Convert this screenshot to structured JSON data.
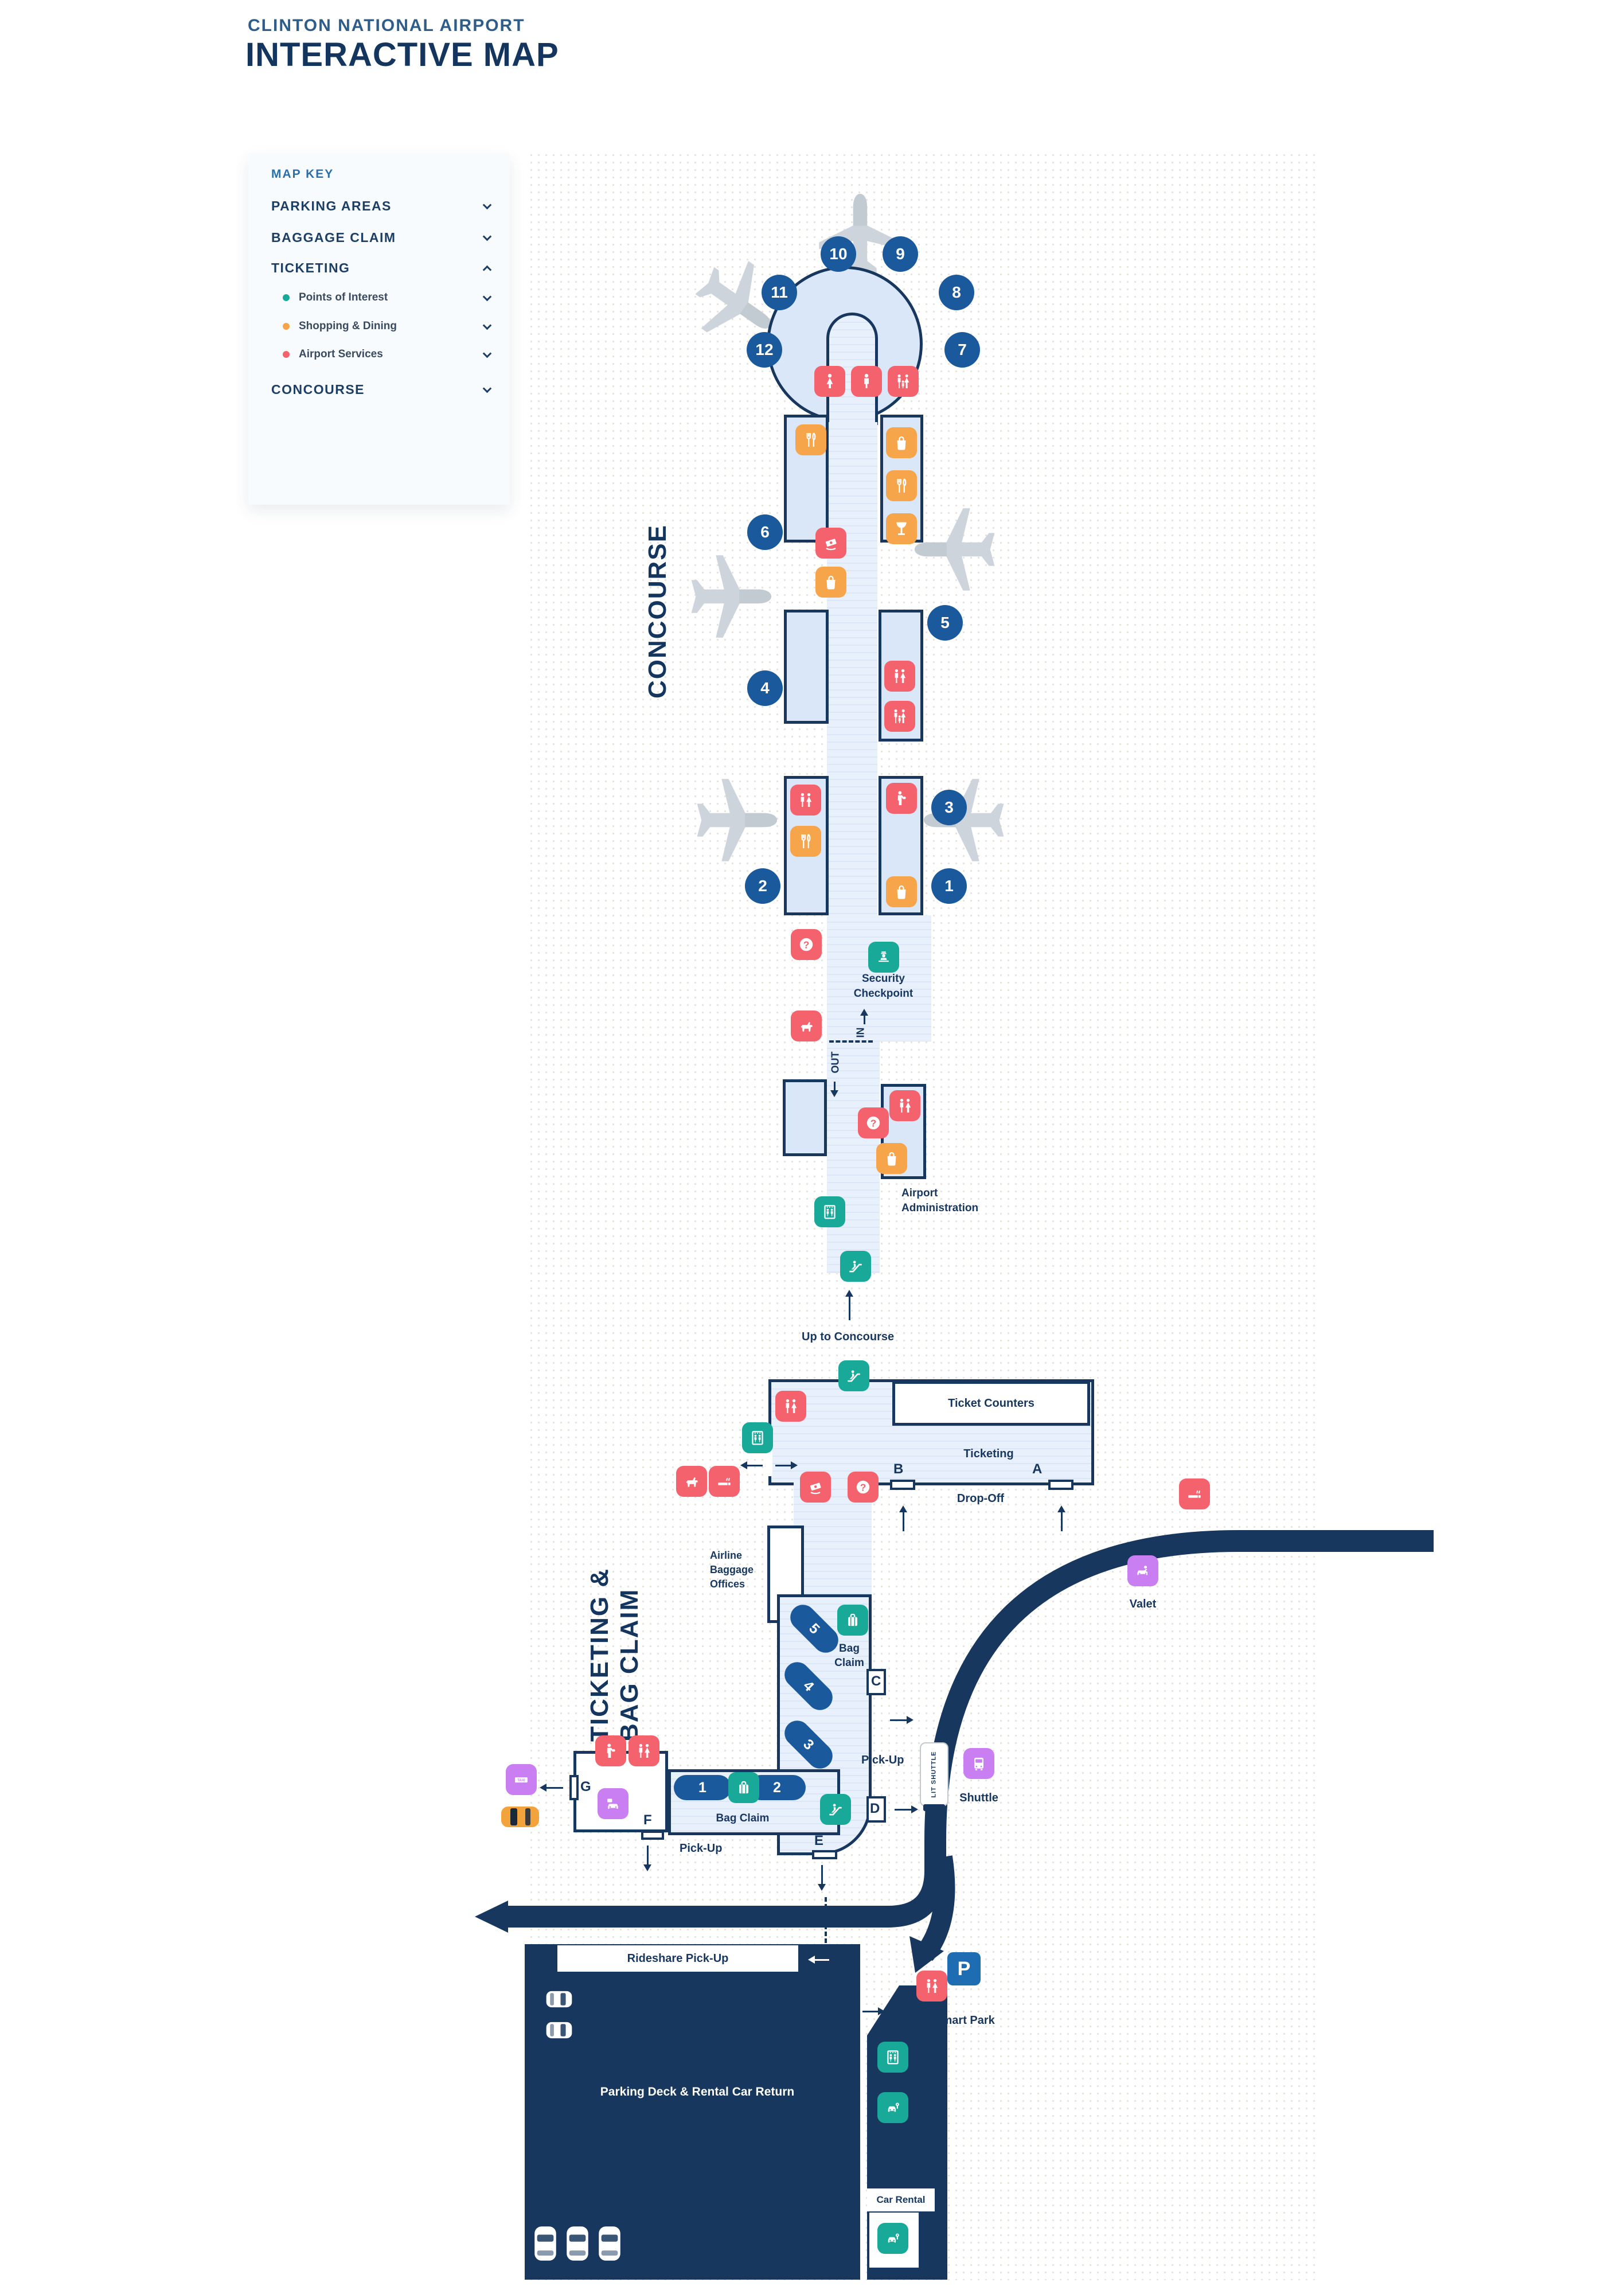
{
  "header": {
    "airport_name": "CLINTON NATIONAL AIRPORT",
    "page_title": "INTERACTIVE MAP"
  },
  "map_key": {
    "title": "MAP KEY",
    "sections": [
      {
        "label": "PARKING AREAS",
        "expanded": false
      },
      {
        "label": "BAGGAGE CLAIM",
        "expanded": false
      },
      {
        "label": "TICKETING",
        "expanded": true
      },
      {
        "label": "CONCOURSE",
        "expanded": false
      }
    ],
    "ticketing_categories": [
      {
        "label": "Points of Interest",
        "dot_color": "#18a999"
      },
      {
        "label": "Shopping & Dining",
        "dot_color": "#f6a54b"
      },
      {
        "label": "Airport Services",
        "dot_color": "#f4626e"
      }
    ]
  },
  "zones": {
    "concourse": "CONCOURSE",
    "ticketing_line1": "TICKETING &",
    "ticketing_line2": "BAG CLAIM"
  },
  "gates": [
    "1",
    "2",
    "3",
    "4",
    "5",
    "6",
    "7",
    "8",
    "9",
    "10",
    "11",
    "12"
  ],
  "doors": [
    "A",
    "B",
    "C",
    "D",
    "E",
    "F",
    "G"
  ],
  "carousels": [
    "1",
    "2",
    "3",
    "4",
    "5"
  ],
  "labels": {
    "security_line1": "Security",
    "security_line2": "Checkpoint",
    "in": "IN",
    "out": "OUT",
    "admin_line1": "Airport",
    "admin_line2": "Administration",
    "up_to_concourse": "Up to Concourse",
    "ticket_counters": "Ticket Counters",
    "ticketing": "Ticketing",
    "drop_off": "Drop-Off",
    "airline_line1": "Airline",
    "airline_line2": "Baggage",
    "airline_line3": "Offices",
    "valet": "Valet",
    "bag_claim_line1": "Bag",
    "bag_claim_line2": "Claim",
    "bag_claim": "Bag Claim",
    "pick_up_east": "Pick-Up",
    "pick_up_south": "Pick-Up",
    "shuttle": "Shuttle",
    "lit_shuttle": "LIT SHUTTLE",
    "rideshare": "Rideshare Pick-Up",
    "parking_deck": "Parking Deck & Rental Car Return",
    "smart_park_p": "P",
    "smart_park": "Smart Park",
    "car_rental": "Car Rental",
    "taxi_sign": "TAXI"
  },
  "colors": {
    "navy": "#17375e",
    "room_fill": "#d9e7f8",
    "gate_blue": "#1a5a9c",
    "red": "#f4626e",
    "orange": "#f6a54b",
    "teal": "#18a999",
    "purple": "#c97ff2",
    "smart_park_blue": "#1e6cb2",
    "plane_gray": "#cdd4db"
  },
  "icons": [
    "woman-icon",
    "man-icon",
    "family-restroom-icon",
    "restroom-icon",
    "nursing-room-icon",
    "dining-icon",
    "shopping-bag-icon",
    "bar-icon",
    "atm-icon",
    "info-icon",
    "pet-relief-icon",
    "smoking-icon",
    "drink-icon",
    "security-officer-icon",
    "elevator-icon",
    "escalator-icon",
    "bag-claim-icon",
    "rental-car-key-icon",
    "taxi-icon",
    "rental-car-icon",
    "valet-icon",
    "shuttle-bus-icon",
    "parking-icon",
    "airplane-icon",
    "chevron-down-icon",
    "chevron-up-icon"
  ]
}
